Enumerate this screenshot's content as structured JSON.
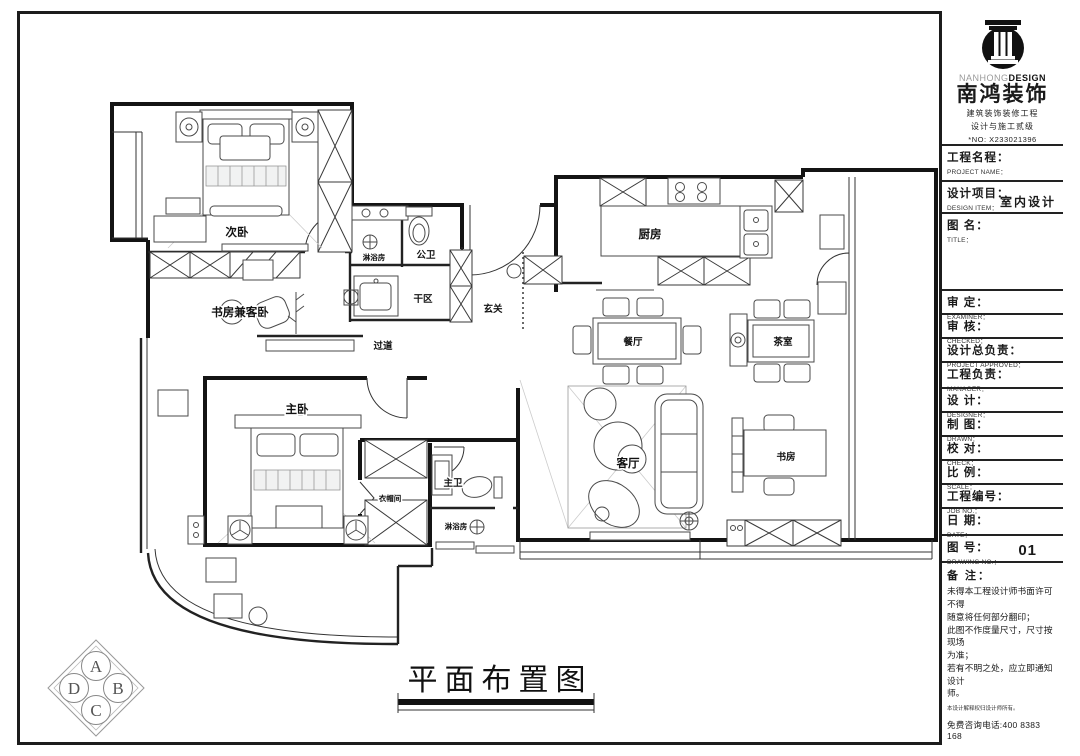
{
  "brand": {
    "name_gray": "NANHONG",
    "name_bold": "DESIGN",
    "company": "南鸿装饰",
    "tagline1": "建筑装饰装修工程",
    "tagline2": "设计与施工贰级",
    "no": "*NO: X233021396"
  },
  "titleblock": {
    "rows": [
      {
        "zh": "工程名程：",
        "en": "PROJECT NAME：",
        "value": ""
      },
      {
        "zh": "设计项目：",
        "en": "DESIGN ITEM：",
        "value": "室内设计"
      },
      {
        "zh": "图  名：",
        "en": "TITLE：",
        "value": ""
      },
      {
        "zh": "审  定：",
        "en": "EXAMINER：",
        "value": ""
      },
      {
        "zh": "审  核：",
        "en": "CHECKED：",
        "value": ""
      },
      {
        "zh": "设计总负责：",
        "en": "PROJECT APPROVED：",
        "value": ""
      },
      {
        "zh": "工程负责：",
        "en": "MANAGER：",
        "value": ""
      },
      {
        "zh": "设  计：",
        "en": "DESIGNER：",
        "value": ""
      },
      {
        "zh": "制  图：",
        "en": "DRAWN：",
        "value": ""
      },
      {
        "zh": "校  对：",
        "en": "CHECK：",
        "value": ""
      },
      {
        "zh": "比  例：",
        "en": "SCALE：",
        "value": ""
      },
      {
        "zh": "工程编号：",
        "en": "JOB  NO.：",
        "value": ""
      },
      {
        "zh": "日  期：",
        "en": "DATE：",
        "value": ""
      },
      {
        "zh": "图  号：",
        "en": "DRAWING NO.：",
        "value": "01"
      }
    ],
    "notes": {
      "heading": "备 注：",
      "body": "未得本工程设计师书面许可不得\n随意将任何部分翻印；\n此图不作度量尺寸，尺寸按现场\n为准；\n若有不明之处，应立即通知设计\n师。",
      "tiny": "本设计解释权归设计师所有。",
      "phone": "免费咨询电话:400 8383 168"
    }
  },
  "drawing_title": {
    "text": "平面布置图"
  },
  "elevation_marker": {
    "top": "A",
    "left": "D",
    "right": "B",
    "bottom": "C"
  },
  "plan": {
    "rooms": [
      {
        "label": "次卧"
      },
      {
        "label": "书房兼客卧"
      },
      {
        "label": "淋浴房"
      },
      {
        "label": "公卫"
      },
      {
        "label": "干区"
      },
      {
        "label": "玄关"
      },
      {
        "label": "过道"
      },
      {
        "label": "厨房"
      },
      {
        "label": "餐厅"
      },
      {
        "label": "茶室"
      },
      {
        "label": "客厅"
      },
      {
        "label": "书房"
      },
      {
        "label": "主卧"
      },
      {
        "label": "衣帽间"
      },
      {
        "label": "主卫"
      },
      {
        "label": "淋浴房"
      }
    ]
  },
  "colors": {
    "wall": "#141414",
    "accent": "#111111",
    "muted": "#9a9a9a"
  }
}
